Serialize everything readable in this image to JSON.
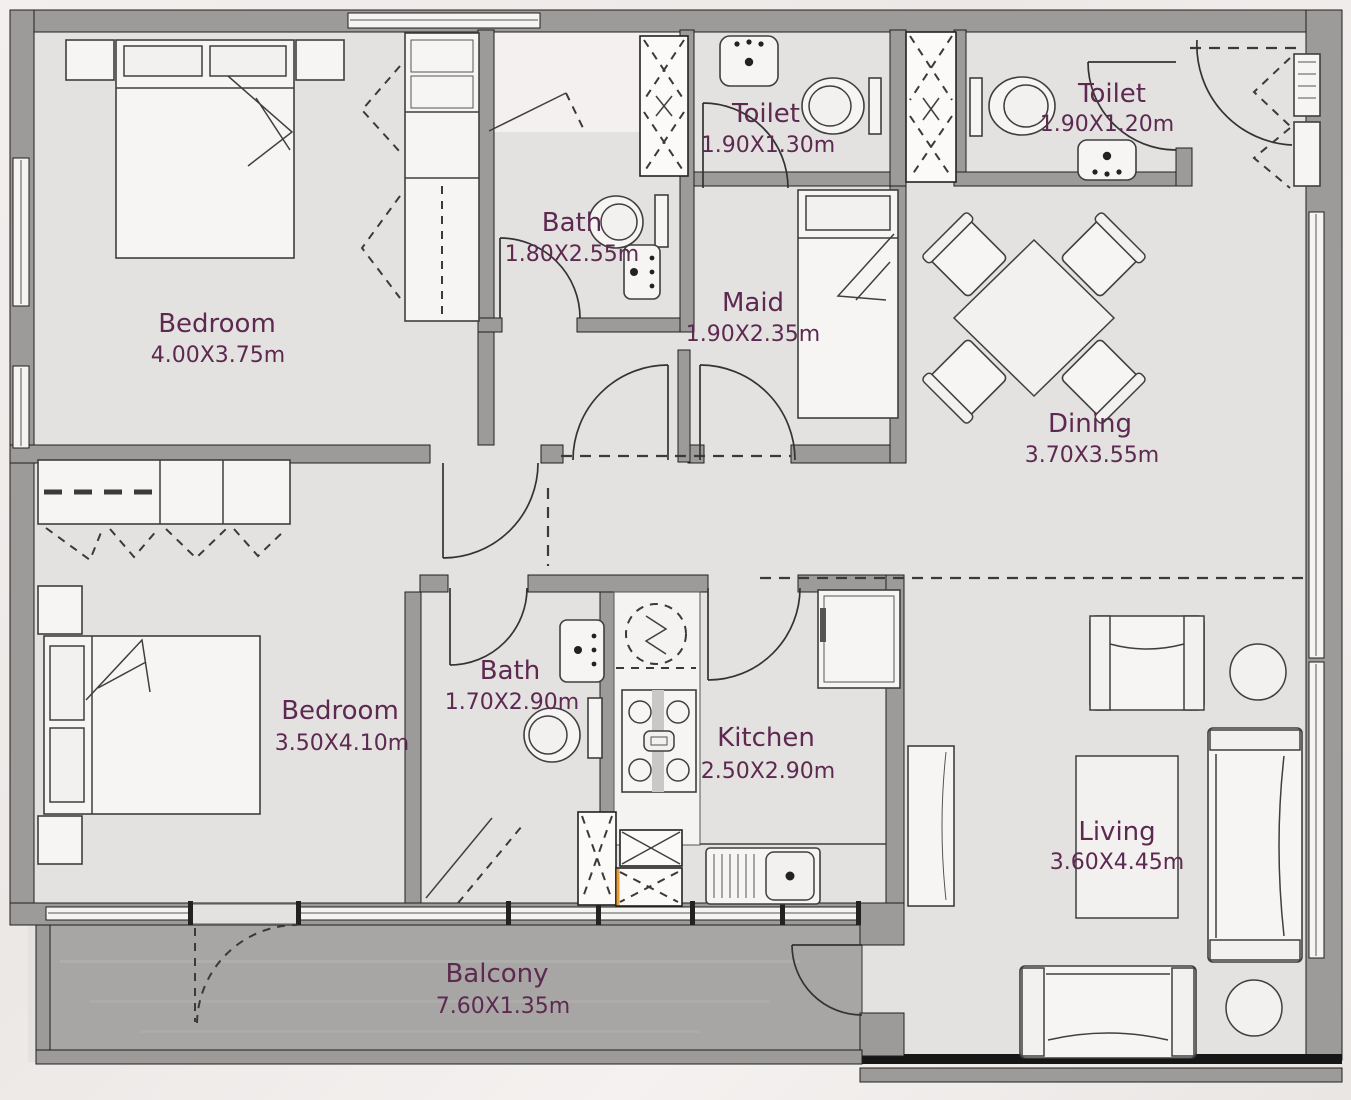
{
  "meta": {
    "title": "apartment-floor-plan"
  },
  "colors": {
    "label_text": "#5d2950",
    "room_floor": "#e4e2e1",
    "wall": "#9c9b9a",
    "balcony_floor": "#a7a6a5",
    "furniture": "#f7f5f4",
    "shaft_accent": "#e89b33",
    "background": "#efecea"
  },
  "rooms": [
    {
      "name": "Bedroom",
      "dims": "4.00X3.75m"
    },
    {
      "name": "Bath",
      "dims": "1.80X2.55m"
    },
    {
      "name": "Toilet",
      "dims": "1.90X1.30m"
    },
    {
      "name": "Toilet",
      "dims": "1.90X1.20m"
    },
    {
      "name": "Maid",
      "dims": "1.90X2.35m"
    },
    {
      "name": "Dining",
      "dims": "3.70X3.55m"
    },
    {
      "name": "Bedroom",
      "dims": "3.50X4.10m"
    },
    {
      "name": "Bath",
      "dims": "1.70X2.90m"
    },
    {
      "name": "Kitchen",
      "dims": "2.50X2.90m"
    },
    {
      "name": "Living",
      "dims": "3.60X4.45m"
    },
    {
      "name": "Balcony",
      "dims": "7.60X1.35m"
    }
  ],
  "appliances": {
    "washer_label": "W"
  }
}
